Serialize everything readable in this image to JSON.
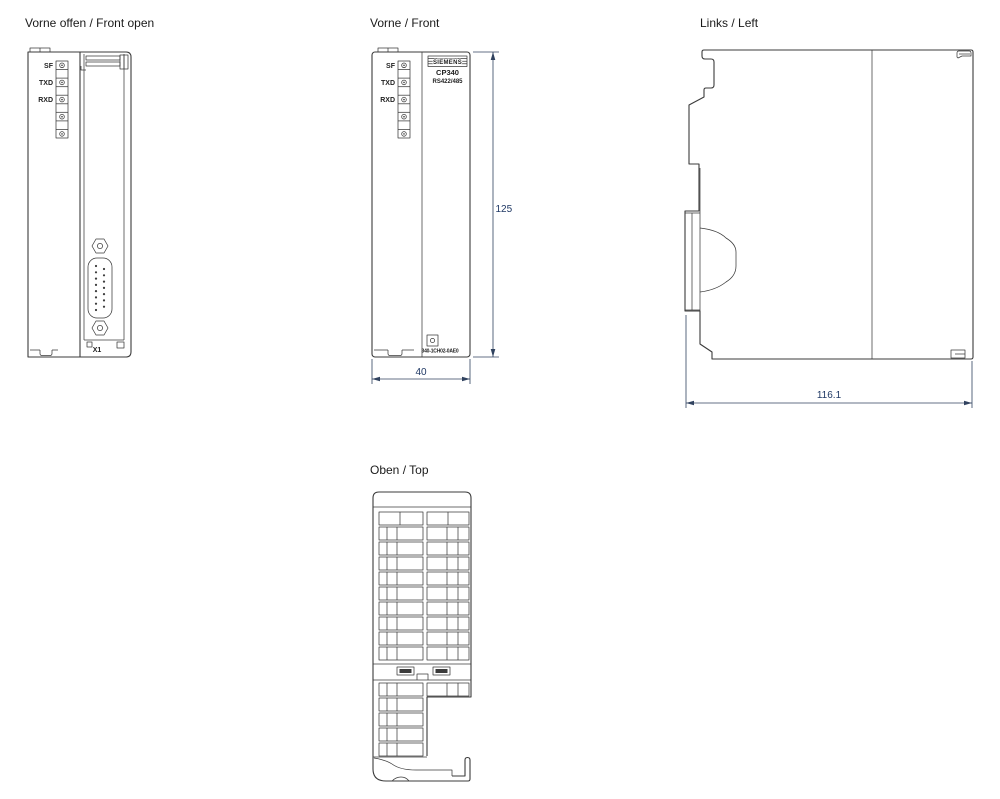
{
  "colors": {
    "line": "#3b3b3b",
    "dim_text": "#1f3864",
    "heading": "#1a1a1a"
  },
  "views": {
    "front_open": {
      "title": "Vorne offen / Front open",
      "leds": [
        "SF",
        "TXD",
        "RXD"
      ],
      "connector": "X1"
    },
    "front": {
      "title": "Vorne / Front",
      "leds": [
        "SF",
        "TXD",
        "RXD"
      ],
      "brand": "SIEMENS",
      "product": "CP340",
      "interface": "RS422/485",
      "order_no": "340-1CH02-0AE0",
      "dims": {
        "height": "125",
        "width": "40"
      }
    },
    "left": {
      "title": "Links / Left",
      "dims": {
        "depth": "116.1"
      }
    },
    "top": {
      "title": "Oben / Top"
    }
  }
}
